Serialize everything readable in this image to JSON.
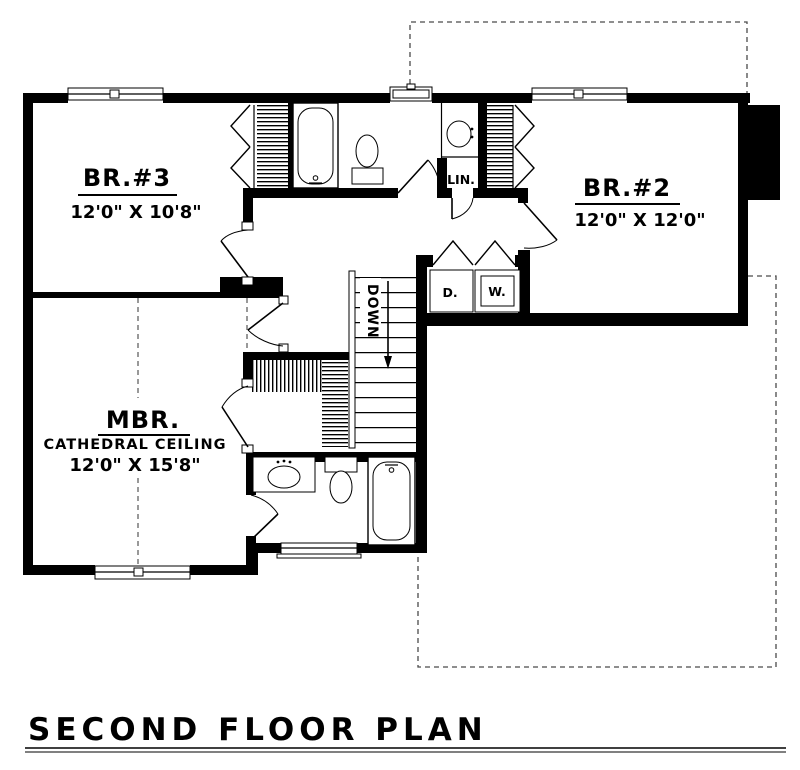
{
  "title": "SECOND FLOOR PLAN",
  "rooms": {
    "br3": {
      "name": "BR.#3",
      "dims": "12'0\" X 10'8\""
    },
    "br2": {
      "name": "BR.#2",
      "dims": "12'0\" X 12'0\""
    },
    "mbr": {
      "name": "MBR.",
      "ceiling": "CATHEDRAL CEILING",
      "dims": "12'0\" X 15'8\""
    }
  },
  "labels": {
    "linen": "LIN.",
    "dryer": "D.",
    "washer": "W.",
    "stair_direction": "DOWN"
  },
  "colors": {
    "walls": "#000000",
    "background": "#ffffff",
    "dashed_lines": "#4a4a4a"
  }
}
